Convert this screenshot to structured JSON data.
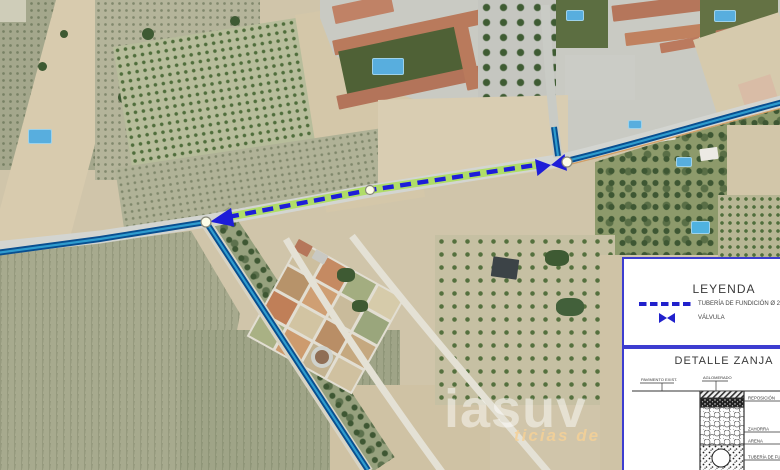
{
  "map": {
    "type": "aerial-orthophoto",
    "overlay_elements": [
      "existing-pipe-lines",
      "new-pipe-dashed-line",
      "flow-arrow",
      "valve",
      "junction-nodes"
    ]
  },
  "legend": {
    "title": "LEYENDA",
    "items": [
      {
        "symbol": "dashed-line",
        "label": "TUBERÍA DE FUNDICIÓN Ø 2"
      },
      {
        "symbol": "valve",
        "label": "VÁLVULA"
      }
    ],
    "detail": {
      "title": "DETALLE ZANJA",
      "labels": {
        "top_left": "PAVIMENTO EXIST.",
        "top_right": "AGLOMERADO",
        "right_1": "REPOSICIÓN",
        "right_2": "ZAHORRA",
        "right_3": "ARENA",
        "right_4": "TUBERÍA DE FUNDICIÓN"
      }
    }
  },
  "watermark": {
    "main": "iasuv",
    "tagline": "ticias de"
  },
  "colors": {
    "new_pipe_dash": "#1d1dd8",
    "new_pipe_glow": "#a8de4d",
    "existing_pipe": "#084f90",
    "existing_pipe_core": "#2f9cce",
    "legend_border": "#3d3dd0",
    "pool_blue": "#58aede"
  }
}
